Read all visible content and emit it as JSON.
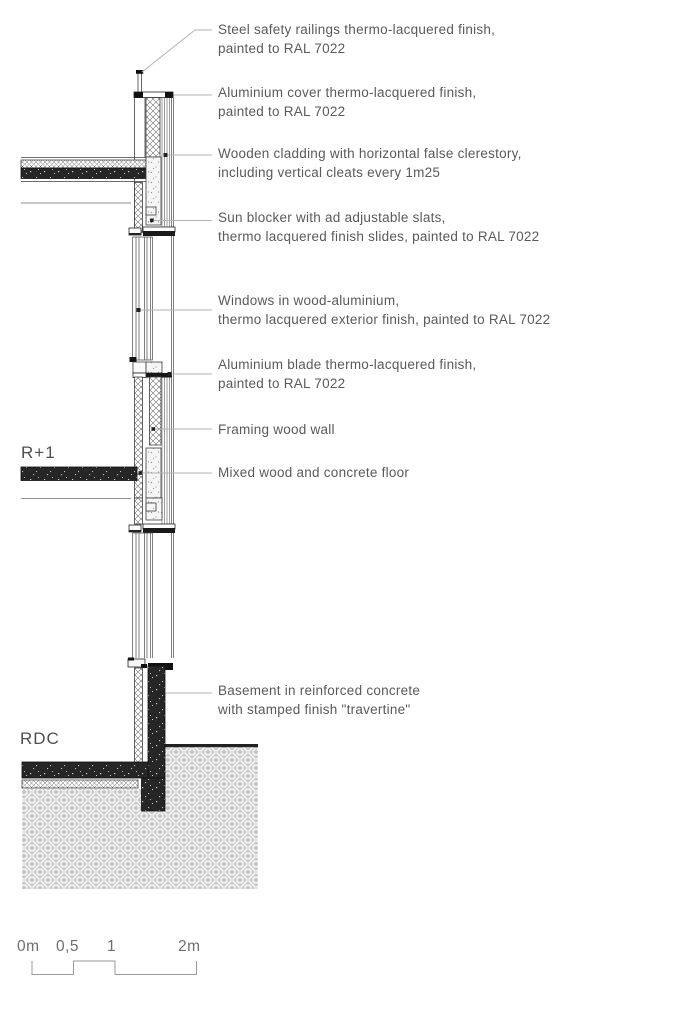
{
  "annotations": [
    {
      "id": "steel-safety-railings",
      "lines": [
        "Steel safety railings thermo-lacquered finish,",
        "painted to RAL 7022"
      ]
    },
    {
      "id": "aluminium-cover",
      "lines": [
        "Aluminium cover thermo-lacquered finish,",
        "painted to RAL 7022"
      ]
    },
    {
      "id": "wooden-cladding",
      "lines": [
        "Wooden cladding with horizontal false clerestory,",
        "including vertical cleats every 1m25"
      ]
    },
    {
      "id": "sun-blocker",
      "lines": [
        "Sun blocker with ad adjustable slats,",
        "thermo lacquered finish slides, painted to RAL 7022"
      ]
    },
    {
      "id": "windows",
      "lines": [
        "Windows in wood-aluminium,",
        "thermo lacquered exterior finish, painted to RAL 7022"
      ]
    },
    {
      "id": "aluminium-blade",
      "lines": [
        "Aluminium blade thermo-lacquered finish,",
        "painted to RAL 7022"
      ]
    },
    {
      "id": "framing-wood-wall",
      "lines": [
        "Framing wood wall"
      ]
    },
    {
      "id": "mixed-floor",
      "lines": [
        "Mixed wood and concrete floor"
      ]
    },
    {
      "id": "basement",
      "lines": [
        "Basement in reinforced concrete",
        "with stamped finish \"travertine\""
      ]
    }
  ],
  "levels": {
    "upper": "R+1",
    "ground": "RDC"
  },
  "scale_bar": {
    "labels": [
      "0m",
      "0,5",
      "1",
      "2m"
    ]
  },
  "colors": {
    "line": "#3f3f3f",
    "concrete": "#262626",
    "leader": "#b3b3b3",
    "text": "#5a5a5a",
    "ground": "#c8c8c8"
  }
}
